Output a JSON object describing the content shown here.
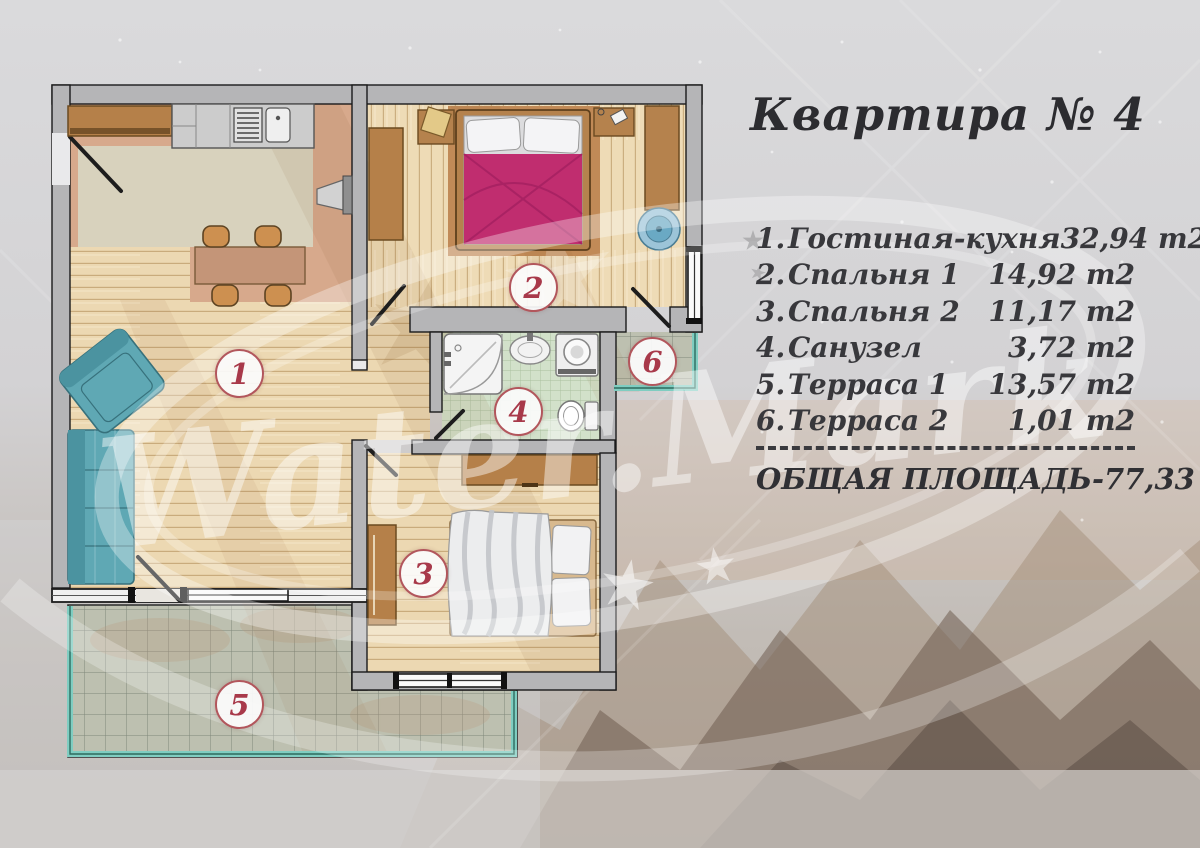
{
  "title": "Квартира № 4",
  "legend": {
    "items": [
      {
        "num": "1.",
        "name": "Гостиная-кухня",
        "area": "32,94 m2"
      },
      {
        "num": "2.",
        "name": "Спальня 1",
        "area": "14,92 m2"
      },
      {
        "num": "3.",
        "name": "Спальня 2",
        "area": "11,17 m2"
      },
      {
        "num": "4.",
        "name": "Санузел",
        "area": "3,72 m2"
      },
      {
        "num": "5.",
        "name": "Терраса 1",
        "area": "13,57 m2"
      },
      {
        "num": "6.",
        "name": "Терраса 2",
        "area": "1,01 m2"
      }
    ],
    "total": "ОБЩАЯ ПЛОЩАДЬ-77,33 m2"
  },
  "plan": {
    "rooms": {
      "living_kitchen": {
        "label": "1",
        "name": "Гостиная-кухня"
      },
      "bedroom1": {
        "label": "2",
        "name": "Спальня 1"
      },
      "bedroom2": {
        "label": "3",
        "name": "Спальня 2"
      },
      "bathroom": {
        "label": "4",
        "name": "Санузел"
      },
      "terrace1": {
        "label": "5",
        "name": "Терраса 1"
      },
      "terrace2": {
        "label": "6",
        "name": "Терраса 2"
      }
    }
  },
  "watermark": {
    "text": "Water.Mark"
  },
  "colors": {
    "accent_red": "#a8394a",
    "badge_border": "#b2565c",
    "bed_cover_magenta": "#c02d6f",
    "sofa_teal": "#5fa8b4",
    "glass_teal": "#7fcdc1",
    "wall_gray": "#b5b5b7",
    "wood_floor": "#ecd8b2",
    "kitchen_zone": "#d8d2bd",
    "salmon_zone": "#d5a habitable"
  }
}
